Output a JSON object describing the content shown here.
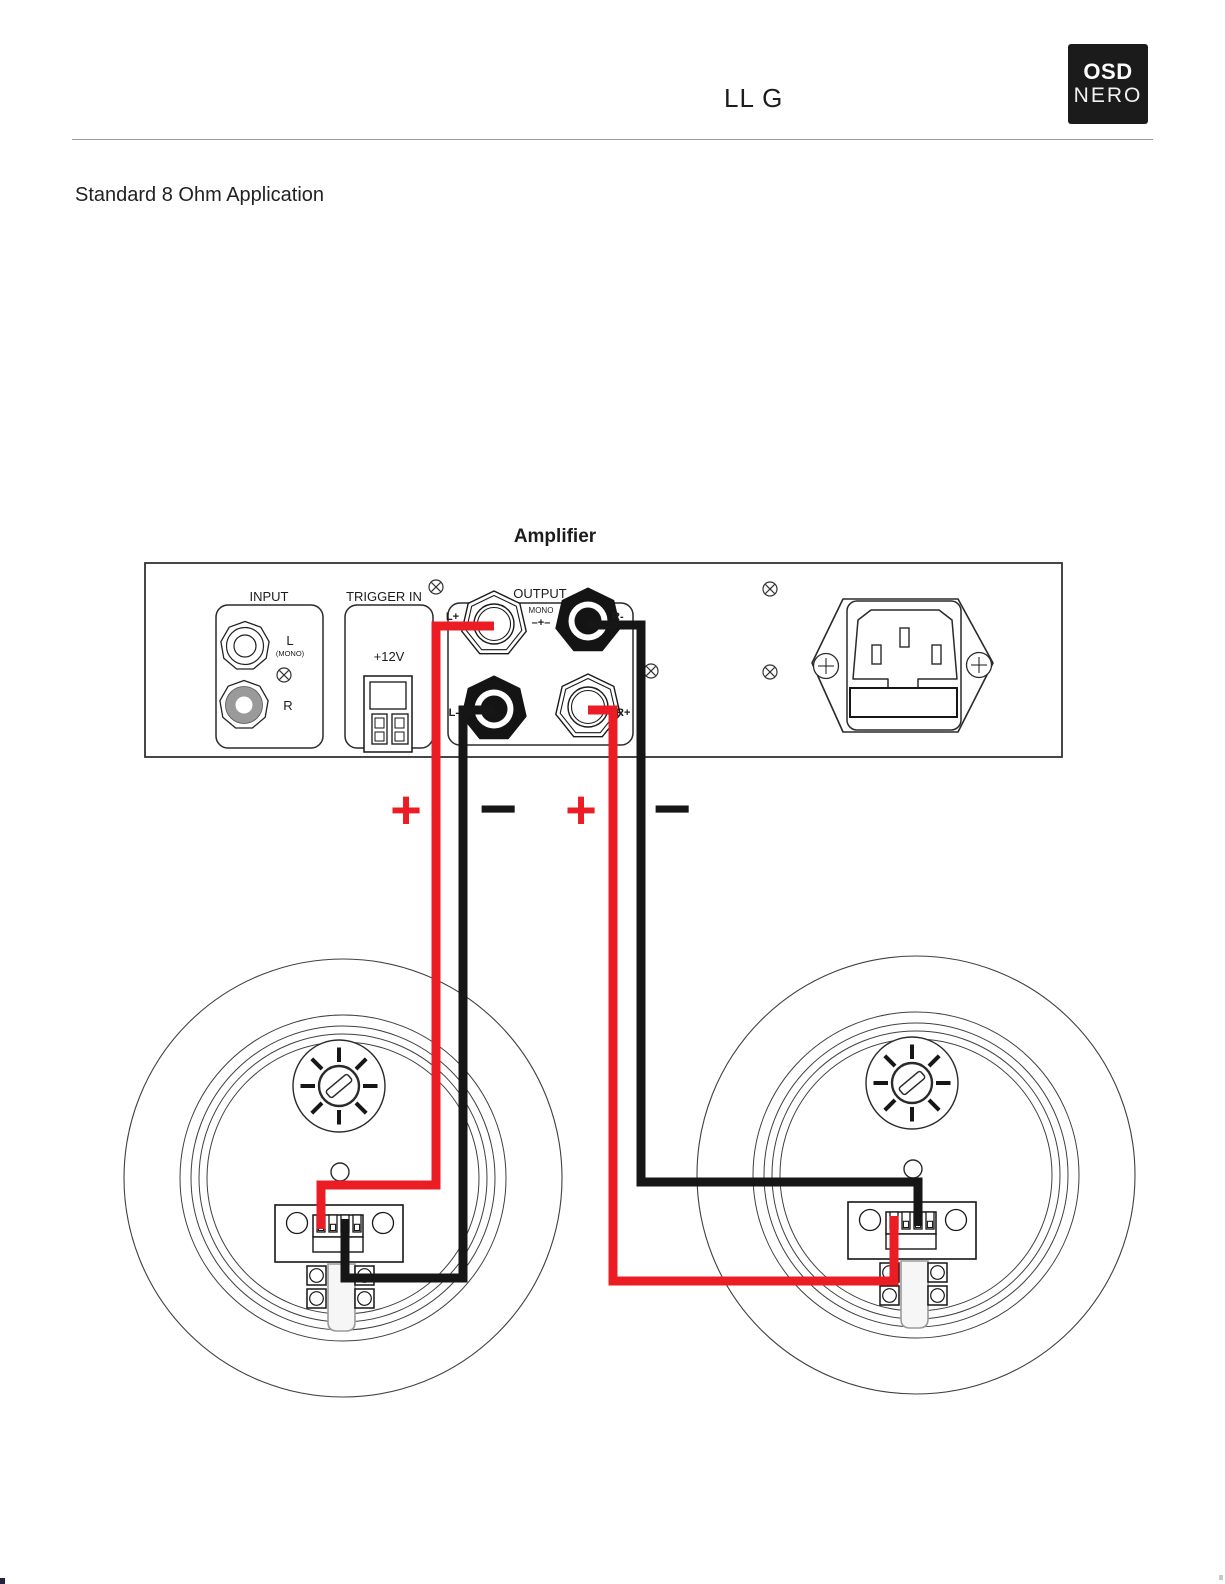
{
  "header": {
    "doc_code": "LL G",
    "logo": {
      "line1": "OSD",
      "line2": "NERO"
    }
  },
  "section_title": "Standard 8 Ohm Application",
  "amplifier": {
    "label": "Amplifier",
    "input": {
      "label": "INPUT",
      "jack_left_label": "L",
      "jack_left_sub": "(MONO)",
      "jack_right_label": "R"
    },
    "trigger": {
      "label": "TRIGGER IN",
      "voltage_label": "+12V"
    },
    "output": {
      "label": "OUTPUT",
      "mono_label": "MONO",
      "mono_polarity": "–+–",
      "posts": [
        {
          "label": "L+"
        },
        {
          "label": "R-"
        },
        {
          "label": "L-"
        },
        {
          "label": "R+"
        }
      ]
    }
  },
  "polarity_markers": [
    {
      "symbol": "+",
      "color": "#EC1C24"
    },
    {
      "symbol": "−",
      "color": "#161616"
    },
    {
      "symbol": "+",
      "color": "#EC1C24"
    },
    {
      "symbol": "−",
      "color": "#161616"
    }
  ],
  "colors": {
    "positive_wire": "#EC1C24",
    "negative_wire": "#161616",
    "jack_gray": "#9a9a9a",
    "line": "#2a2a2a"
  }
}
